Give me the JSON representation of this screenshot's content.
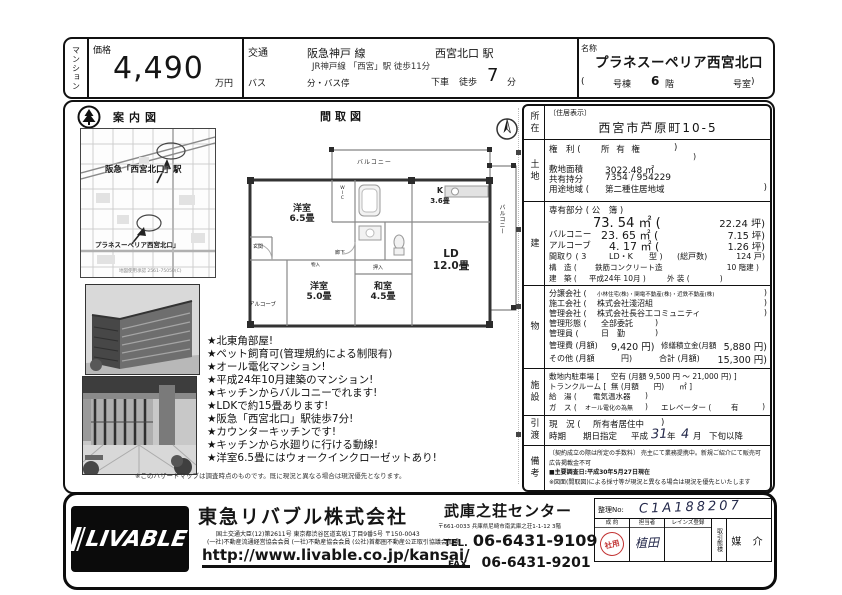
{
  "header": {
    "category": "マンション",
    "price_label": "価格",
    "price_value": "4,490",
    "price_unit": "万円",
    "transport_label": "交通",
    "rail_line": "阪急神戸 線",
    "rail_station": "西宮北口 駅",
    "rail_sub": "JR神戸線 「西宮」駅  徒歩11分",
    "bus_label": "バス",
    "bus_stop": "分・バス停",
    "alight": "下車",
    "walk": "徒歩",
    "walk_min": "7",
    "walk_unit": "分",
    "name_label": "名称",
    "name_value": "プラネスーペリア西宮北口",
    "unit_open": "(",
    "unit_building": "号棟",
    "unit_floor": "6",
    "unit_floor_unit": "階",
    "unit_room": "号室",
    "unit_close": ")"
  },
  "map": {
    "title": "案内図",
    "station_label": "阪急「西宮北口」駅",
    "property_label": "プラネスーペリア西宮北口」",
    "credit": "地図使用承認 2561-75050(C)"
  },
  "floorplan": {
    "title": "間取図",
    "balcony_top": "バルコニー",
    "balcony_right": "バルコニー",
    "room1_name": "洋室",
    "room1_size": "6.5畳",
    "kitchen_name": "K",
    "kitchen_size": "3.6畳",
    "ld_name": "LD",
    "ld_size": "12.0畳",
    "washitsu_name": "和室",
    "washitsu_size": "4.5畳",
    "room2_name": "洋室",
    "room2_size": "5.0畳",
    "alcove": "アルコーブ",
    "hall": "廊下",
    "entrance": "玄関",
    "closet": "押入",
    "storage": "物入",
    "wic": "WIC"
  },
  "features": [
    "★北東角部屋!",
    "★ペット飼育可(管理規約による制限有)",
    "★オール電化マンション!",
    "★平成24年10月建築のマンション!",
    "★キッチンからバルコニーでれます!",
    "★LDKで約15畳あります!",
    "★阪急「西宮北口」駅徒歩7分!",
    "★カウンターキッチンです!",
    "★キッチンから水廻りに行ける動線!",
    "★洋室6.5畳にはウォークインクローゼットあり!"
  ],
  "features_note": "※このハザードマップは調査時点のものです。既に現況と異なる場合は現況優先となります。",
  "details": {
    "location": {
      "label": "所在",
      "tag": "〔住居表示〕",
      "address": "西宮市芦原町10-5"
    },
    "land": {
      "label": "土地",
      "rights_label": "権　利 (",
      "rights_value": "所 有 権",
      "close": ")",
      "area_label": "敷地面積",
      "area_value": "3022.48 ㎡",
      "share_label": "共有持分",
      "share_value": "7354 / 954229",
      "zoning_label": "用途地域 (",
      "zoning_value": "第二種住居地域",
      "zoning_close": ")"
    },
    "building": {
      "label": "建",
      "exclusive_label": "専有部分 ( 公　簿 )",
      "exclusive_value": "73. 54 ㎡ (",
      "exclusive_tsubo": "22.24 坪)",
      "balcony_label": "バルコニー",
      "balcony_value": "23. 65 ㎡ (",
      "balcony_tsubo": "7.15 坪)",
      "alcove_label": "アルコーブ",
      "alcove_value": "4. 17 ㎡ (",
      "alcove_tsubo": "1.26 坪)",
      "madori_label": "間取り ( 3",
      "madori_type": "LD・K",
      "madori_close": "型 )",
      "units_label": "(総戸数)",
      "units_value": "124 戸)",
      "structure_label": "構　造 (",
      "structure_value": "鉄筋コンクリート造",
      "structure_tail": "10 階建 )",
      "built_label": "建　築 (",
      "built_value": "平成24年 10月 )",
      "built_tail": "外 装 (　　　　)"
    },
    "management": {
      "label": "物",
      "seller_label": "分譲会社 (",
      "seller_value": "小林住宅(株)・関電不動産(株)・近鉄不動産(株)",
      "close": ")",
      "builder_label": "施工会社 (",
      "builder_value": "株式会社淺沼組",
      "mgmt_label": "管理会社 (",
      "mgmt_value": "株式会社長谷工コミュニティ",
      "form_label": "管理形態 (",
      "form_value": "全部委託",
      "super_label": "管理員 (",
      "super_value": "日　勤",
      "fee_label": "管理費 (月額)",
      "fee_value": "9,420 円)",
      "repair_label": "修繕積立金(月額",
      "repair_value": "5,880 円)",
      "other_label": "その他 (月額",
      "other_value": "円)",
      "total_label": "合計 (月額)",
      "total_value": "15,300 円)"
    },
    "facility": {
      "label": "施設",
      "parking_label": "敷地内駐車場 [",
      "parking_value": "空有  (月額 9,500 円 〜 21,000 円) ]",
      "trunk_label": "トランクルーム [",
      "trunk_value": "無  (月額　　円)　　㎡ ]",
      "water_label": "給　湯 (",
      "water_value": "電気温水器",
      "close": ")",
      "gas_label": "ガ　ス (",
      "gas_value": "オール電化の為無",
      "gas_close": ")",
      "elevator_label": "エレベーター (",
      "elevator_value": "有",
      "elevator_close": ")"
    },
    "handover": {
      "label": "引渡",
      "status_label": "現　況 (",
      "status_value": "所有者居住中",
      "close": ")",
      "timing_label": "時期",
      "timing_type": "期日指定",
      "era": "平成",
      "year": "31",
      "year_unit": "年",
      "month": "4",
      "month_unit": "月",
      "tail": "下旬以降"
    },
    "remarks": {
      "label": "備考",
      "lines": [
        "〔契約成立の際は所定の手数料〕 売主にて業務提携中。新規ご紹介にて販売可",
        "広告掲載金不可",
        "■主要調査日:平成30年5月27日現在",
        "※図面(間取図)による採寸等が現況と異なる場合は現況を優先といたします"
      ]
    }
  },
  "footer": {
    "logo": "LIVABLE",
    "company": "東急リバブル株式会社",
    "license1": "国土交通大臣(12)第2611号 東京都渋谷区道玄坂1丁目9番5号 〒150-0043",
    "license2": "(一社)不動産流通経営協会会員 (一社)不動産協会会員 (公社)首都圏不動産公正取引協議会加盟",
    "url": "http://www.livable.co.jp/kansai/",
    "office": "武庫之荘センター",
    "office_address": "〒661-0033 兵庫県尼崎市南武庫之荘1-1-12 3階",
    "tel_label": "TEL.",
    "tel": "06-6431-9109",
    "fax_label": "FAX.",
    "fax": "06-6431-9201",
    "ref_label": "整理No:",
    "ref_value": "C1A188207",
    "seiyaku_label": "成  約",
    "stamp_text": "社用",
    "staff_label": "担当者",
    "staff_value": "植田",
    "reins_label": "レインズ登録",
    "deal_label": "取引態様",
    "deal_value": "媒 介"
  }
}
